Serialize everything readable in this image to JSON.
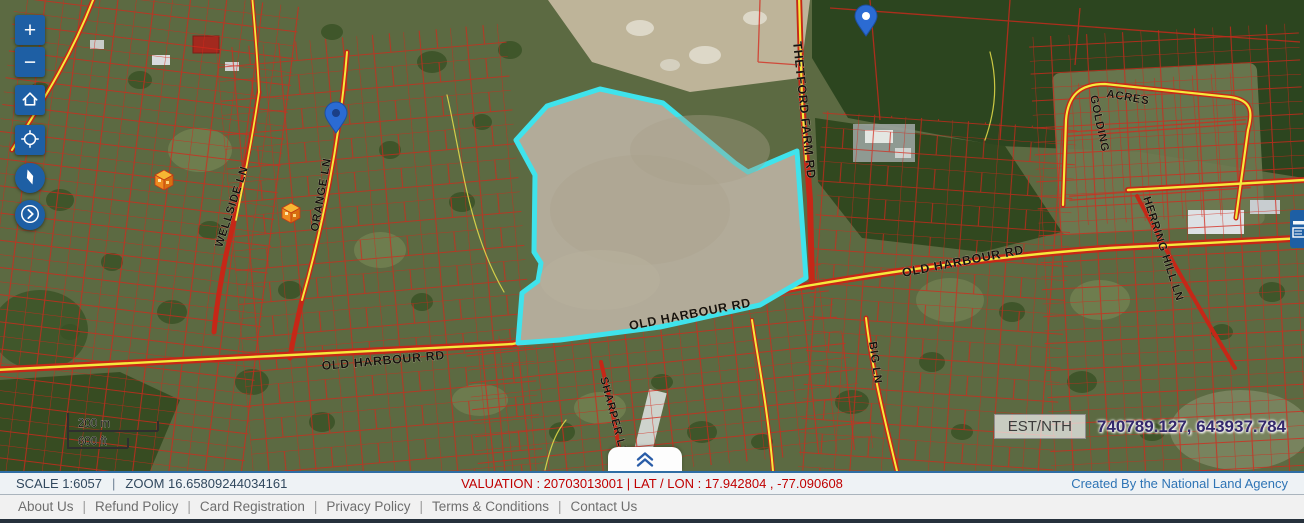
{
  "map_controls": {
    "zoom_in_label": "+",
    "zoom_out_label": "−"
  },
  "scale_bar": {
    "metric": "200 m",
    "imperial": "600 ft"
  },
  "coordinate_readout": {
    "label": "EST/NTH",
    "value": "740789.127, 643937.784"
  },
  "status_bar": {
    "scale": "SCALE 1:6057",
    "separator": "|",
    "zoom": "ZOOM 16.65809244034161",
    "valuation": "VALUATION : 20703013001 | LAT / LON : 17.942804 , -77.090608",
    "credit": "Created By the National Land Agency"
  },
  "footer": {
    "separator": "|",
    "links": [
      "About Us",
      "Refund Policy",
      "Card Registration",
      "Privacy Policy",
      "Terms & Conditions",
      "Contact Us"
    ]
  },
  "map": {
    "labels": {
      "wellside": "WELLSIDE LN",
      "orange": "ORANGE LN",
      "thetford": "THETFORD FARM RD",
      "golding_line1": "GOLDING",
      "golding_line2": "ACRES",
      "herring": "HERRING HILL LN",
      "old_harbour": "OLD HARBOUR RD",
      "sharper": "SHARPER LN",
      "big": "BIG LN"
    }
  },
  "colors": {
    "accent_blue": "#1e5fa4",
    "parcel_highlight": "#3fe3ec",
    "cadastral_red": "#d5281c",
    "road_yellow": "#f5e93d",
    "valuation_red": "#c00000",
    "credit_blue": "#2e74b5"
  }
}
